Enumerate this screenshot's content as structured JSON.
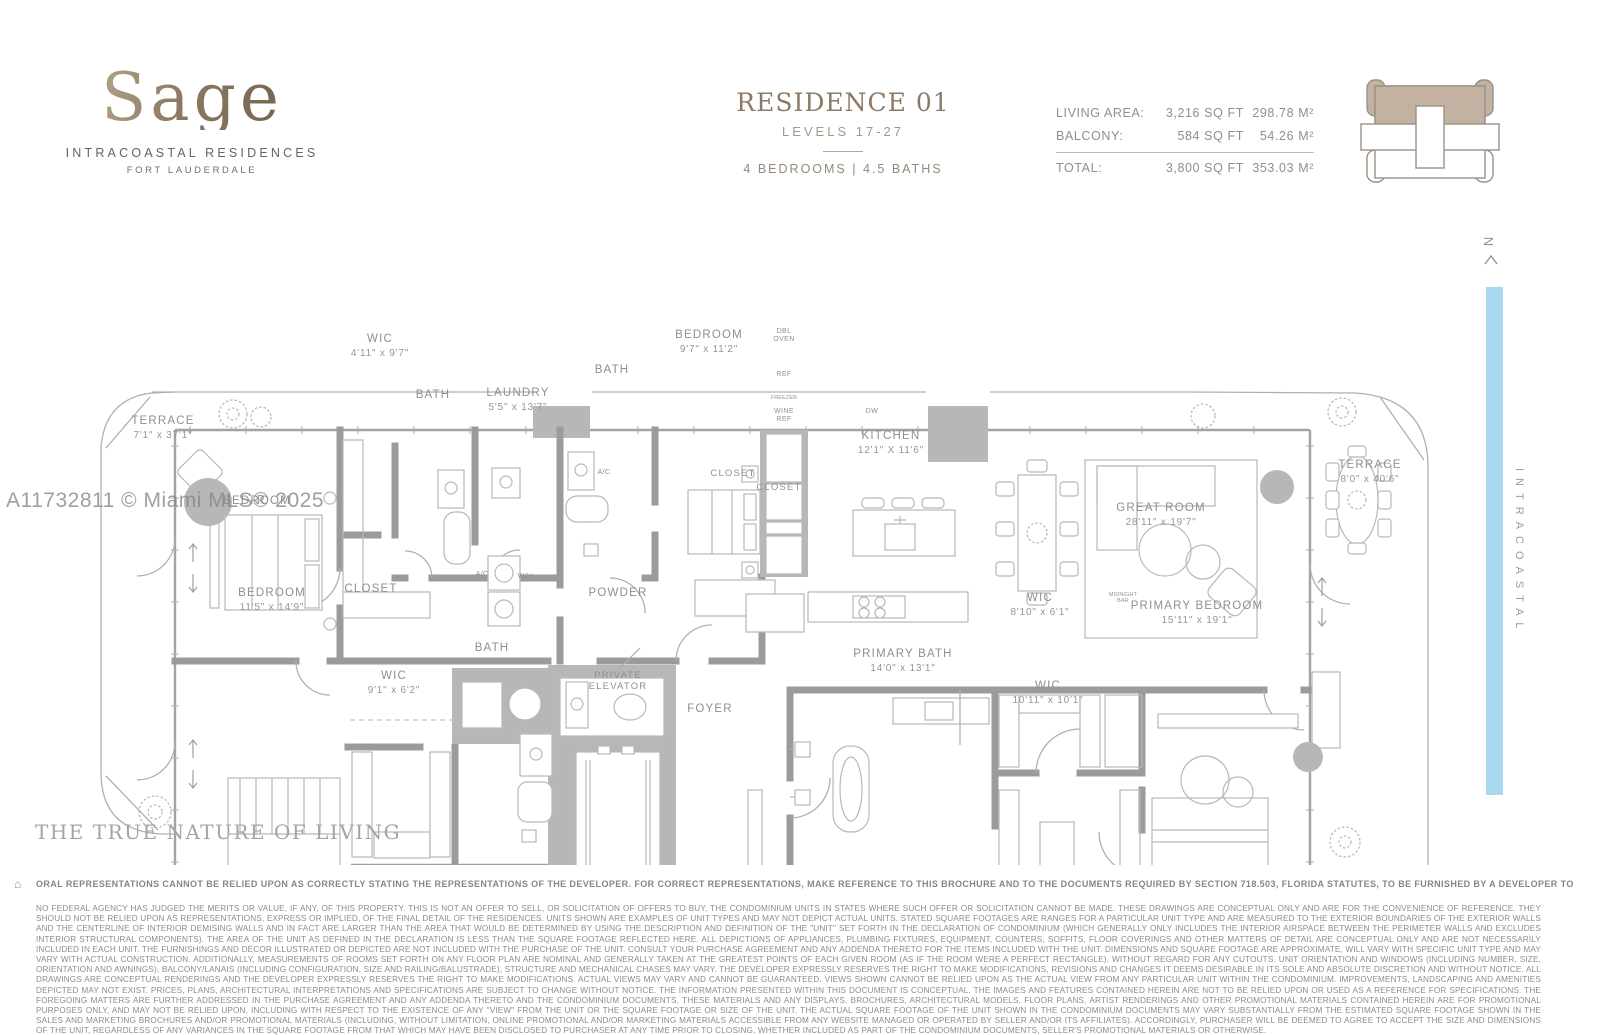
{
  "brand": {
    "name": "Sage",
    "subtitle": "INTRACOASTAL RESIDENCES",
    "city": "FORT LAUDERDALE"
  },
  "header": {
    "residence": "RESIDENCE 01",
    "levels": "LEVELS 17-27",
    "config": "4 BEDROOMS  |  4.5 BATHS"
  },
  "stats": {
    "rows": [
      {
        "label": "LIVING AREA:",
        "sqft": "3,216 SQ FT",
        "metric": "298.78 M²"
      },
      {
        "label": "BALCONY:",
        "sqft": "584 SQ FT",
        "metric": "54.26 M²"
      }
    ],
    "total": {
      "label": "TOTAL:",
      "sqft": "3,800 SQ FT",
      "metric": "353.03 M²"
    }
  },
  "compass": {
    "label": "N"
  },
  "waterway": {
    "label": "INTRACOASTAL",
    "color": "#a9d9f1"
  },
  "watermark": {
    "text": "A11732811 © Miami MLS® 2025"
  },
  "tagline": {
    "text": "THE TRUE NATURE OF LIVING"
  },
  "disclaimer": {
    "icon": "⌂",
    "bold": "ORAL REPRESENTATIONS CANNOT BE RELIED UPON AS CORRECTLY STATING THE REPRESENTATIONS OF THE DEVELOPER. FOR CORRECT REPRESENTATIONS, MAKE REFERENCE TO THIS BROCHURE AND TO THE DOCUMENTS REQUIRED BY SECTION 718.503, FLORIDA STATUTES, TO BE FURNISHED BY A DEVELOPER TO A BUYER OR LESSEE.",
    "body": "NO FEDERAL AGENCY HAS JUDGED THE MERITS OR VALUE, IF ANY, OF THIS PROPERTY. THIS IS NOT AN OFFER TO SELL, OR SOLICITATION OF OFFERS TO BUY, THE CONDOMINIUM UNITS IN STATES WHERE SUCH OFFER OR SOLICITATION CANNOT BE MADE. THESE DRAWINGS ARE CONCEPTUAL ONLY AND ARE FOR THE CONVENIENCE OF REFERENCE. THEY SHOULD NOT BE RELIED UPON AS REPRESENTATIONS, EXPRESS OR IMPLIED, OF THE FINAL DETAIL OF THE RESIDENCES. UNITS SHOWN ARE EXAMPLES OF UNIT TYPES AND MAY NOT DEPICT ACTUAL UNITS. STATED SQUARE FOOTAGES ARE RANGES FOR A PARTICULAR UNIT TYPE AND ARE MEASURED TO THE EXTERIOR BOUNDARIES OF THE EXTERIOR WALLS AND THE CENTERLINE OF INTERIOR DEMISING WALLS AND IN FACT ARE LARGER THAN THE AREA THAT WOULD BE DETERMINED BY USING THE DESCRIPTION AND DEFINITION OF THE \"UNIT\" SET FORTH IN THE DECLARATION OF CONDOMINIUM (WHICH GENERALLY ONLY INCLUDES THE INTERIOR AIRSPACE BETWEEN THE PERIMETER WALLS AND EXCLUDES INTERIOR STRUCTURAL COMPONENTS). THE AREA OF THE UNIT AS DEFINED IN THE DECLARATION IS LESS THAN THE SQUARE FOOTAGE REFLECTED HERE. ALL DEPICTIONS OF APPLIANCES, PLUMBING FIXTURES, EQUIPMENT, COUNTERS, SOFFITS, FLOOR COVERINGS AND OTHER MATTERS OF DETAIL ARE CONCEPTUAL ONLY AND ARE NOT NECESSARILY INCLUDED IN EACH UNIT. THE FURNISHINGS AND DECOR ILLUSTRATED OR DEPICTED ARE NOT INCLUDED WITH THE PURCHASE OF THE UNIT. CONSULT YOUR PURCHASE AGREEMENT AND ANY ADDENDA THERETO FOR THE ITEMS INCLUDED WITH THE UNIT. DIMENSIONS AND SQUARE FOOTAGE ARE APPROXIMATE, WILL VARY WITH SPECIFIC UNIT TYPE AND MAY VARY WITH ACTUAL CONSTRUCTION. ADDITIONALLY, MEASUREMENTS OF ROOMS SET FORTH ON ANY FLOOR PLAN ARE NOMINAL AND GENERALLY TAKEN AT THE GREATEST POINTS OF EACH GIVEN ROOM (AS IF THE ROOM WERE A PERFECT RECTANGLE), WITHOUT REGARD FOR ANY CUTOUTS. UNIT ORIENTATION AND WINDOWS (INCLUDING NUMBER, SIZE, ORIENTATION AND AWNINGS), BALCONY/LANAIS (INCLUDING CONFIGURATION, SIZE AND RAILING/BALUSTRADE), STRUCTURE AND MECHANICAL CHASES MAY VARY. THE DEVELOPER EXPRESSLY RESERVES THE RIGHT TO MAKE MODIFICATIONS, REVISIONS AND CHANGES IT DEEMS DESIRABLE IN ITS SOLE AND ABSOLUTE DISCRETION AND WITHOUT NOTICE. ALL DRAWINGS ARE CONCEPTUAL RENDERINGS AND THE DEVELOPER EXPRESSLY RESERVES THE RIGHT TO MAKE MODIFICATIONS. ACTUAL VIEWS MAY VARY AND CANNOT BE GUARANTEED. VIEWS SHOWN CANNOT BE RELIED UPON AS THE ACTUAL VIEW FROM ANY PARTICULAR UNIT WITHIN THE CONDOMINIUM. IMPROVEMENTS, LANDSCAPING AND AMENITIES DEPICTED MAY NOT EXIST. PRICES, PLANS, ARCHITECTURAL INTERPRETATIONS AND SPECIFICATIONS ARE SUBJECT TO CHANGE WITHOUT NOTICE. THE INFORMATION PRESENTED WITHIN THIS DOCUMENT IS CONCEPTUAL. THE IMAGES AND FEATURES CONTAINED HEREIN ARE NOT TO BE RELIED UPON OR USED AS A REFERENCE FOR SPECIFICATIONS. THE FOREGOING MATTERS ARE FURTHER ADDRESSED IN THE PURCHASE AGREEMENT AND ANY ADDENDA THERETO AND THE CONDOMINIUM DOCUMENTS. THESE MATERIALS AND ANY DISPLAYS, BROCHURES, ARCHITECTURAL MODELS, FLOOR PLANS, ARTIST RENDERINGS AND OTHER PROMOTIONAL MATERIALS CONTAINED HEREIN ARE FOR PROMOTIONAL PURPOSES ONLY, AND MAY NOT BE RELIED UPON, INCLUDING WITH RESPECT TO THE EXISTENCE OF ANY \"VIEW\" FROM THE UNIT OR THE SQUARE FOOTAGE OR SIZE OF THE UNIT. THE ACTUAL SQUARE FOOTAGE OF THE UNIT SHOWN IN THE CONDOMINIUM DOCUMENTS MAY VARY SUBSTANTIALLY FROM THE ESTIMATED SQUARE FOOTAGE SHOWN IN THE SALES AND MARKETING BROCHURES AND/OR PROMOTIONAL MATERIALS (INCLUDING, WITHOUT LIMITATION, ONLINE PROMOTIONAL AND/OR MARKETING MATERIALS ACCESSIBLE FROM ANY WEBSITE MANAGED OR OPERATED BY SELLER AND/OR ITS AFFILIATES). ACCORDINGLY, PURCHASER WILL BE DEEMED TO AGREE TO ACCEPT THE SIZE AND DIMENSIONS OF THE UNIT, REGARDLESS OF ANY VARIANCES IN THE SQUARE FOOTAGE FROM THAT WHICH MAY HAVE BEEN DISCLOSED TO PURCHASER AT ANY TIME PRIOR TO CLOSING, WHETHER INCLUDED AS PART OF THE CONDOMINIUM DOCUMENTS, SELLER'S PROMOTIONAL MATERIALS OR OTHERWISE."
  },
  "floorplan": {
    "labels": [
      {
        "n": "TERRACE",
        "d": "7'1\" x 37'1\"",
        "x": 163,
        "y": 209
      },
      {
        "n": "BEDROOM",
        "x": 257,
        "y": 289
      },
      {
        "n": "WIC",
        "d": "4'11\" x 9'7\"",
        "x": 380,
        "y": 127
      },
      {
        "n": "BATH",
        "x": 433,
        "y": 183
      },
      {
        "n": "LAUNDRY",
        "d": "5'5\" x 13'7\"",
        "x": 518,
        "y": 181
      },
      {
        "n": "BATH",
        "x": 612,
        "y": 158
      },
      {
        "n": "BEDROOM",
        "d": "9'7\" x 11'2\"",
        "x": 709,
        "y": 123
      },
      {
        "n": "KITCHEN",
        "d": "12'1\" X 11'6\"",
        "x": 891,
        "y": 224
      },
      {
        "n": "GREAT ROOM",
        "d": "28'11\" x 19'7\"",
        "x": 1161,
        "y": 296
      },
      {
        "n": "TERRACE",
        "d": "8'0\" x 40'6\"",
        "x": 1370,
        "y": 253
      },
      {
        "n": "BEDROOM",
        "d": "11'5\" x 14'9\"",
        "x": 272,
        "y": 381
      },
      {
        "n": "CLOSET",
        "x": 371,
        "y": 377
      },
      {
        "n": "WIC",
        "d": "9'1\" x 6'2\"",
        "x": 394,
        "y": 464
      },
      {
        "n": "BATH",
        "x": 492,
        "y": 436
      },
      {
        "n": "POWDER",
        "x": 618,
        "y": 381
      },
      {
        "n": "PRIVATE",
        "n2": "ELEVATOR",
        "x": 618,
        "y": 463,
        "s": "sm"
      },
      {
        "n": "FOYER",
        "x": 710,
        "y": 497
      },
      {
        "n": "PRIMARY BATH",
        "d": "14'0\" x 13'1\"",
        "x": 903,
        "y": 442
      },
      {
        "n": "WIC",
        "d": "8'10\" x 6'1\"",
        "x": 1040,
        "y": 386
      },
      {
        "n": "WIC",
        "d": "10'11\" x 10'1\"",
        "x": 1048,
        "y": 474
      },
      {
        "n": "PRIMARY BEDROOM",
        "d": "15'11\" x 19'1\"",
        "x": 1197,
        "y": 394
      },
      {
        "n": "A/C",
        "x": 482,
        "y": 361,
        "s": "xs"
      },
      {
        "n": "W/H",
        "x": 525,
        "y": 363,
        "s": "xs"
      },
      {
        "n": "A/C",
        "x": 604,
        "y": 259,
        "s": "xs"
      },
      {
        "n": "CLOSET",
        "x": 733,
        "y": 261,
        "s": "sm"
      },
      {
        "n": "CLOSET",
        "x": 779,
        "y": 275,
        "s": "sm"
      },
      {
        "n": "DBL",
        "n2": "OVEN",
        "x": 784,
        "y": 118,
        "s": "xs"
      },
      {
        "n": "REF",
        "x": 784,
        "y": 161,
        "s": "xs"
      },
      {
        "n": "FREEZER",
        "x": 784,
        "y": 184,
        "s": "xxs"
      },
      {
        "n": "WINE",
        "n2": "REF",
        "x": 784,
        "y": 198,
        "s": "xs"
      },
      {
        "n": "DW",
        "x": 872,
        "y": 198,
        "s": "xs"
      },
      {
        "n": "MIDNIGHT",
        "n2": "BAR",
        "x": 1123,
        "y": 381,
        "s": "xxs"
      }
    ]
  }
}
